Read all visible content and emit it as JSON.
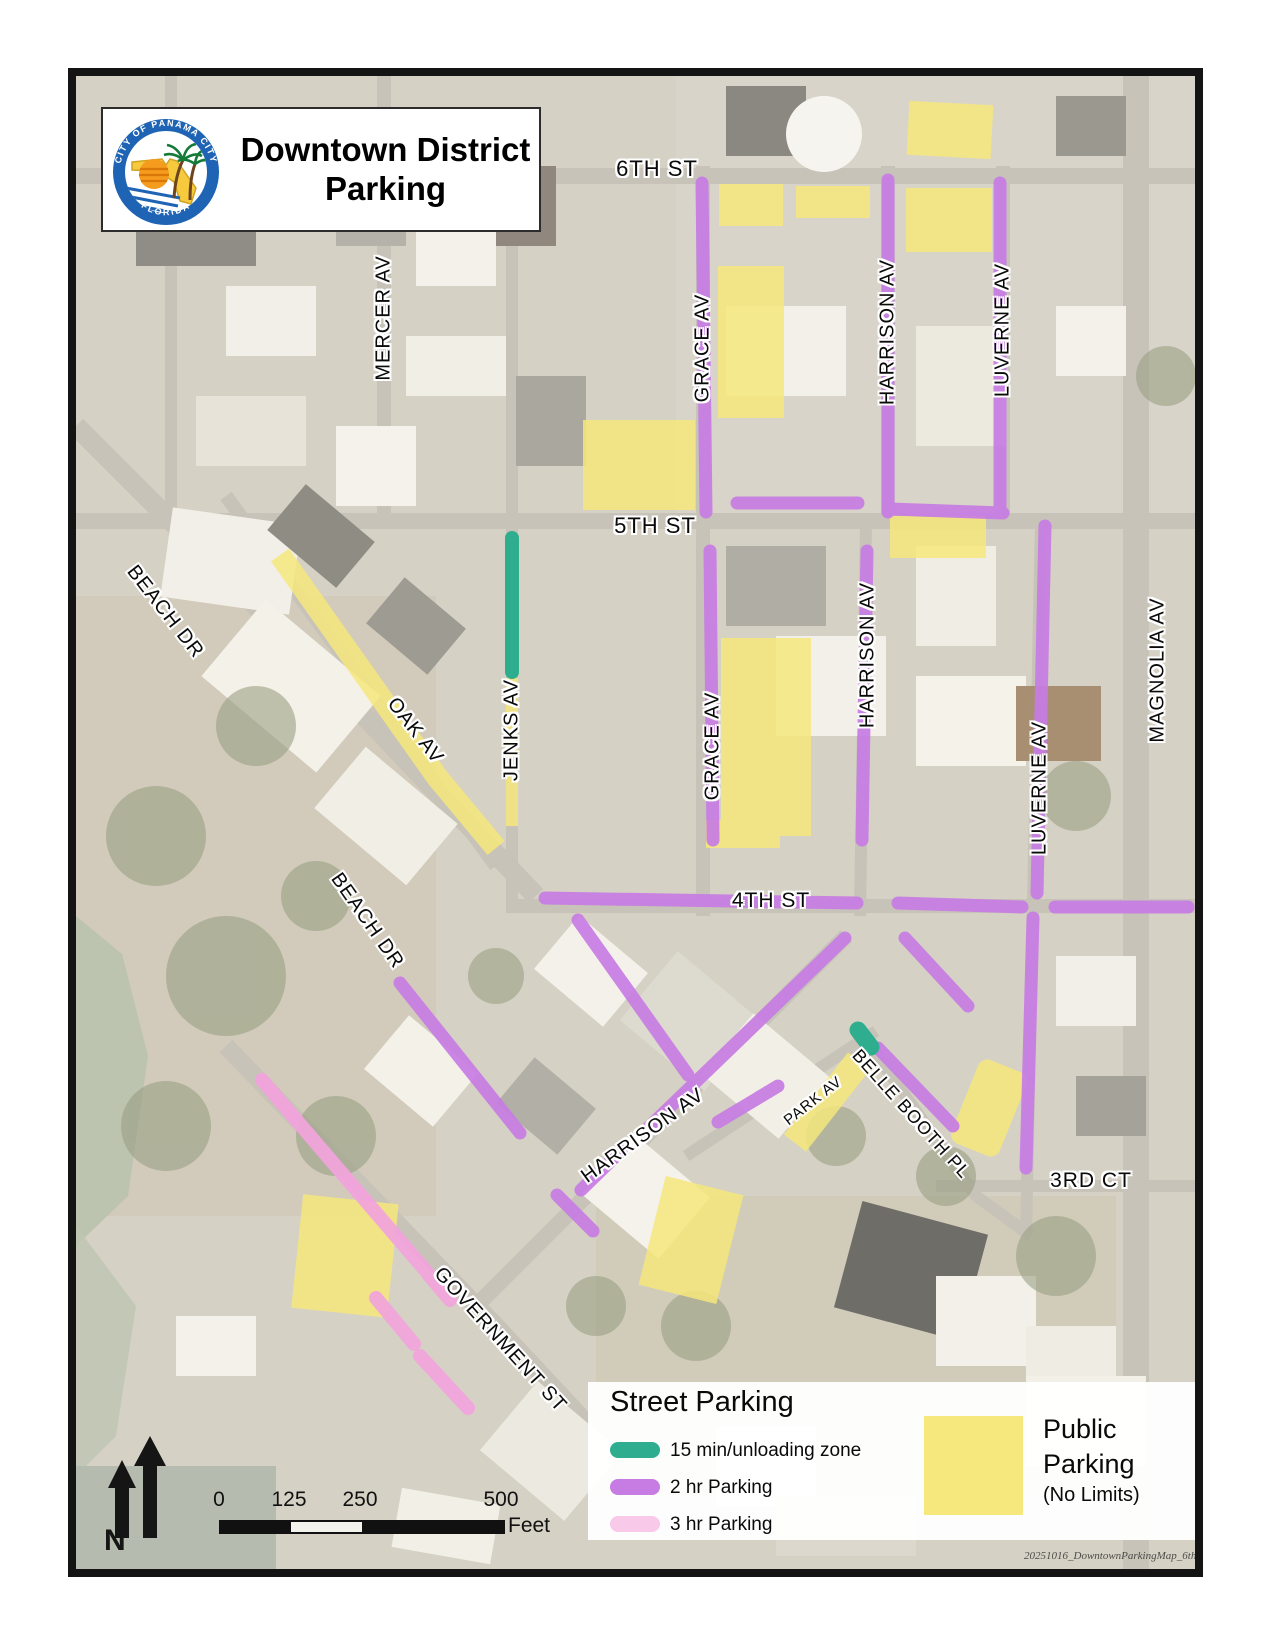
{
  "title_block": {
    "line1": "Downtown District",
    "line2": "Parking",
    "logo": {
      "top_text": "CITY OF PANAMA CITY",
      "bottom_text": "FLORIDA"
    }
  },
  "map": {
    "street_labels": [
      {
        "text": "6TH ST"
      },
      {
        "text": "5TH ST"
      },
      {
        "text": "4TH ST"
      },
      {
        "text": "3RD CT"
      },
      {
        "text": "MERCER AV"
      },
      {
        "text": "GRACE AV"
      },
      {
        "text": "HARRISON AV"
      },
      {
        "text": "LUVERNE AV"
      },
      {
        "text": "JENKS AV"
      },
      {
        "text": "GRACE AV"
      },
      {
        "text": "HARRISON AV"
      },
      {
        "text": "LUVERNE AV"
      },
      {
        "text": "MAGNOLIA AV"
      },
      {
        "text": "BEACH DR"
      },
      {
        "text": "OAK AV"
      },
      {
        "text": "BEACH DR"
      },
      {
        "text": "HARRISON AV"
      },
      {
        "text": "PARK AV"
      },
      {
        "text": "BELLE BOOTH PL"
      },
      {
        "text": "GOVERNMENT ST"
      }
    ]
  },
  "legend": {
    "title": "Street Parking",
    "items": [
      {
        "label": "15 min/unloading zone",
        "color": "#2fae8f"
      },
      {
        "label": "2 hr Parking",
        "color": "#c77ce3"
      },
      {
        "label": "3 hr Parking",
        "color": "#f9c9ea"
      }
    ],
    "public": {
      "line1": "Public",
      "line2": "Parking",
      "line3": "(No Limits)",
      "color": "#f6e87c"
    }
  },
  "scale": {
    "ticks": [
      "0",
      "125",
      "250",
      "500"
    ],
    "unit": "Feet"
  },
  "north": {
    "letter": "N"
  },
  "watermark": {
    "text": "20251016_DowntownParkingMap_6th"
  },
  "colors": {
    "unloading_green": "#2fae8f",
    "two_hr_purple": "#c77ce3",
    "three_hr_pink": "#f2a3dc",
    "public_yellow": "#f6e87c"
  }
}
